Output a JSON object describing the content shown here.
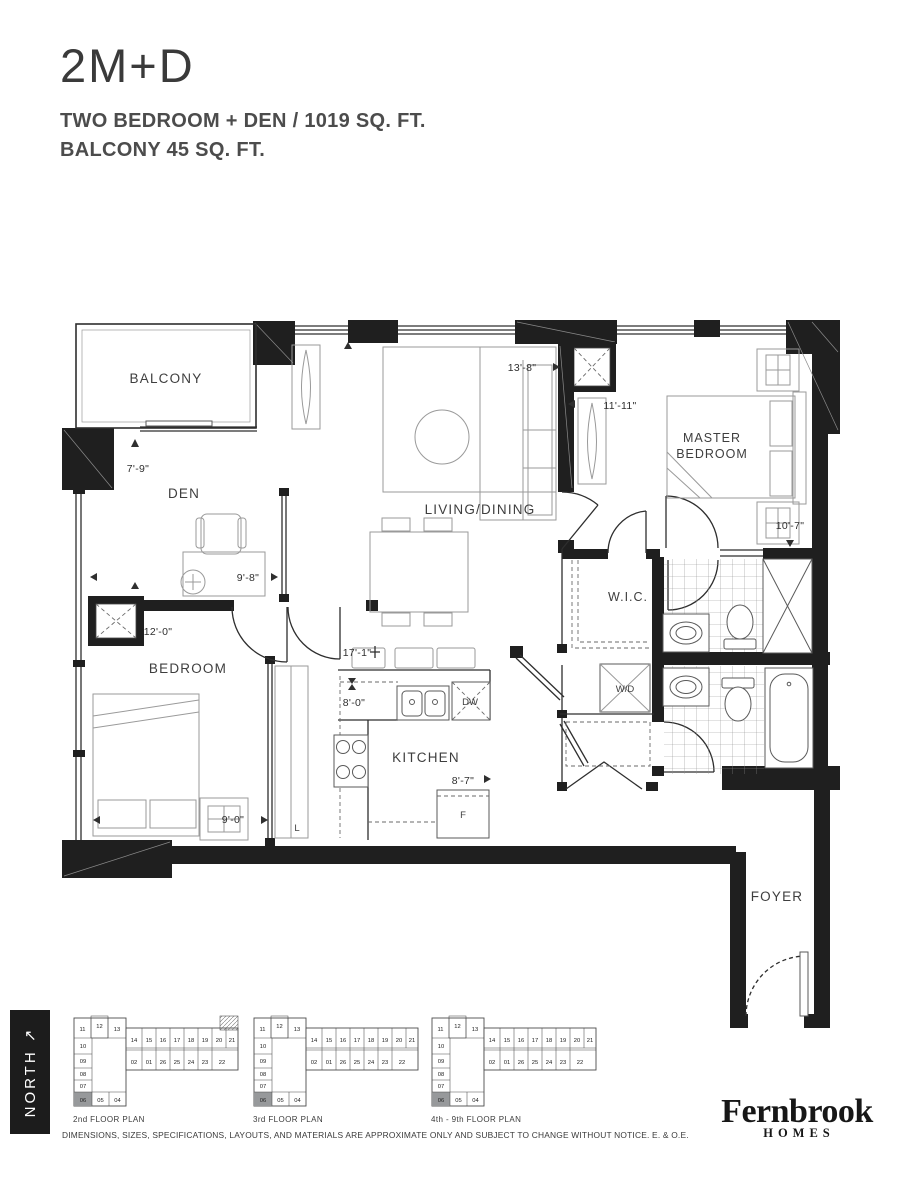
{
  "header": {
    "title": "2M+D",
    "subtitle_line1": "TWO BEDROOM + DEN / 1019 SQ. FT.",
    "subtitle_line2": "BALCONY 45 SQ. FT."
  },
  "plan": {
    "rooms": {
      "balcony": "BALCONY",
      "den": "DEN",
      "living": "LIVING/DINING",
      "master_line1": "MASTER",
      "master_line2": "BEDROOM",
      "bedroom": "BEDROOM",
      "kitchen": "KITCHEN",
      "wic": "W.I.C.",
      "wd": "W/D",
      "foyer": "FOYER"
    },
    "appliances": {
      "dishwasher": "DW",
      "fridge": "F",
      "linen": "L"
    },
    "dimensions": {
      "balcony": "7'-9\"",
      "den": "9'-8\"",
      "living_width": "13'-8\"",
      "living_depth": "11'-11\"",
      "master": "10'-7\"",
      "bedroom_width": "12'-0\"",
      "bedroom_depth": "9'-0\"",
      "kitchen_run": "17'-1\"",
      "kitchen_width": "8'-0\"",
      "kitchen_depth": "8'-7\""
    }
  },
  "north": {
    "label": "NORTH ↗"
  },
  "keyplans": {
    "labels": [
      "2nd FLOOR PLAN",
      "3rd FLOOR PLAN",
      "4th - 9th FLOOR PLAN"
    ]
  },
  "keyplan_units": {
    "top_row": [
      "11",
      "12",
      "13"
    ],
    "left_col": [
      "10",
      "09",
      "08",
      "07"
    ],
    "wing_top": [
      "14",
      "15",
      "16",
      "17",
      "18",
      "19",
      "20",
      "21"
    ],
    "wing_bottom": [
      "02",
      "01",
      "26",
      "25",
      "24",
      "23",
      "22"
    ],
    "bottom_row": [
      "06",
      "05",
      "04"
    ]
  },
  "logo": {
    "name": "Fernbrook",
    "homes": "HOMES"
  },
  "footer": {
    "disclaimer": "DIMENSIONS, SIZES, SPECIFICATIONS, LAYOUTS, AND MATERIALS ARE APPROXIMATE ONLY AND SUBJECT TO CHANGE WITHOUT NOTICE. E. & O.E."
  }
}
